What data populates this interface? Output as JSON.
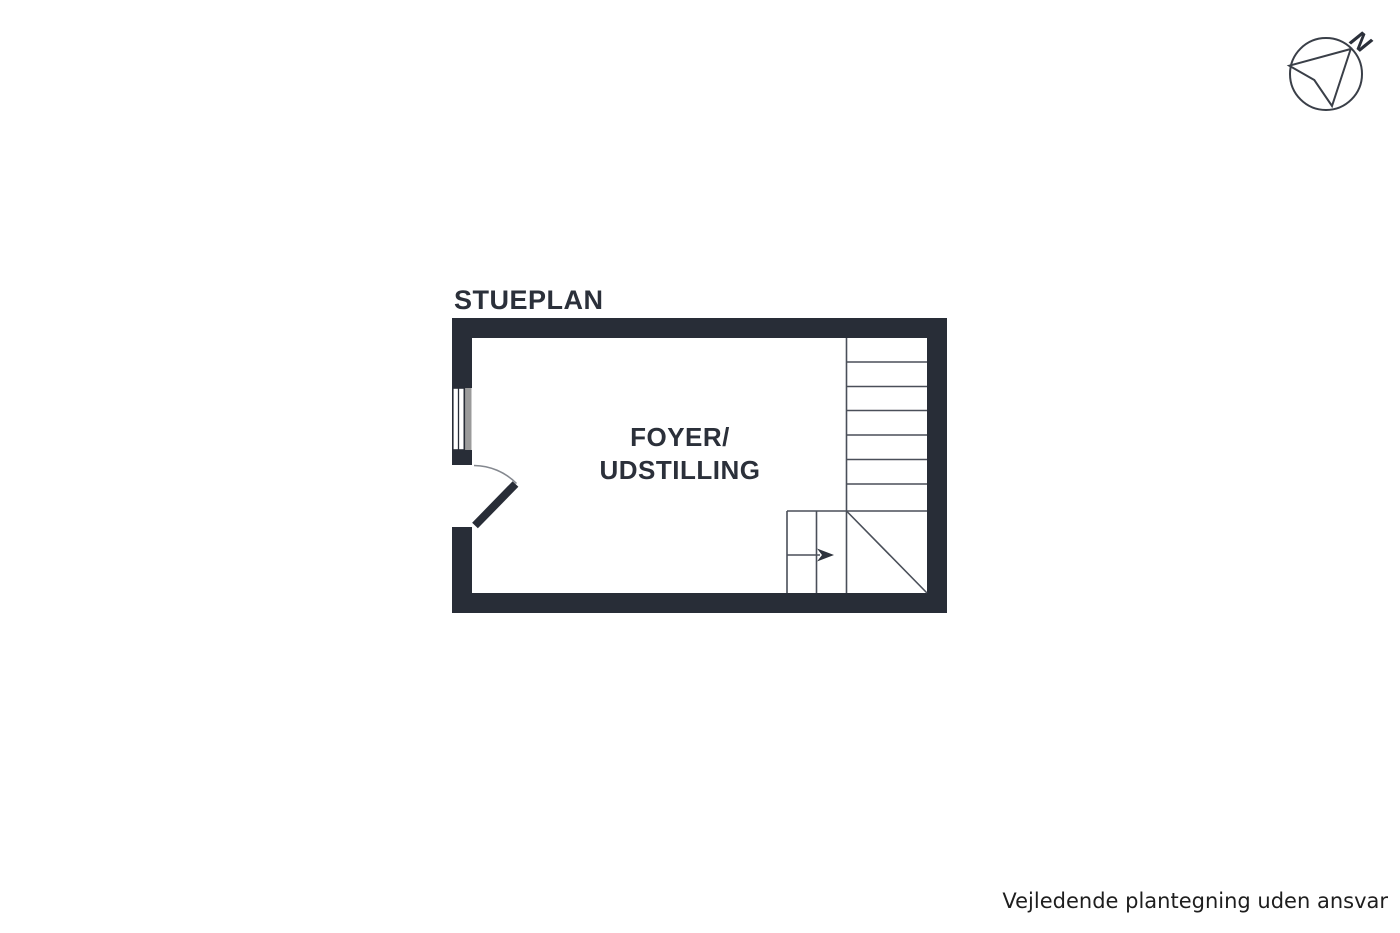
{
  "plan": {
    "title": "STUEPLAN",
    "room": {
      "name": "FOYER/UDSTILLING",
      "label_line1": "FOYER/",
      "label_line2": "UDSTILLING"
    },
    "symbols": {
      "staircase": "staircase-with-winder-treads-and-up-arrow",
      "door": "single-swing-door-opening-inward",
      "window": "double-line-window-in-left-wall"
    }
  },
  "compass": {
    "north_label": "N",
    "direction": "north-east"
  },
  "footer": {
    "disclaimer": "Vejledende plantegning uden ansvar"
  },
  "colors": {
    "background": "#ffffff",
    "wall": "#282d37",
    "stair_line": "#4a4f59",
    "door_arc": "#84888f",
    "arrow_head": "#2e333d",
    "window_gray": "#9b9b9b",
    "label_text": "#2b303a",
    "footer_text": "#1e1e1e",
    "compass_line": "#3a3f48"
  }
}
